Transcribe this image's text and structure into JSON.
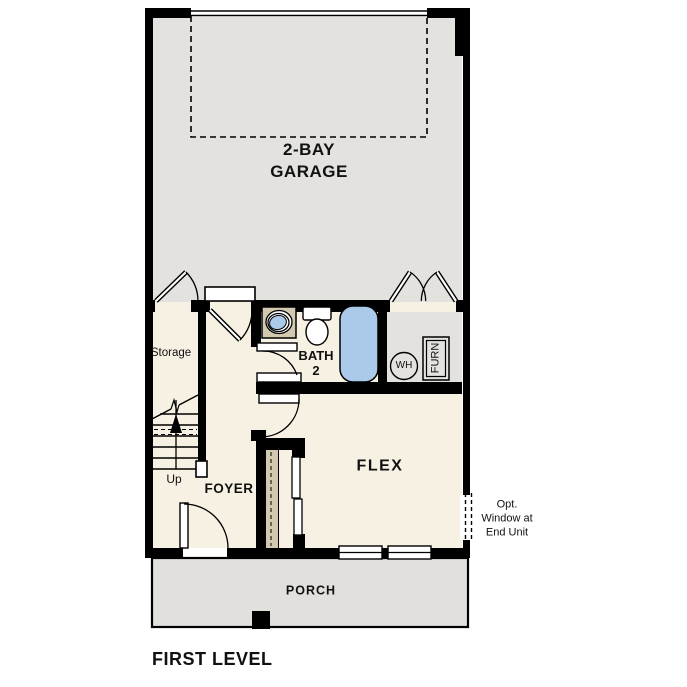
{
  "page_title": "FIRST LEVEL",
  "colors": {
    "wall": "#000000",
    "room_cream": "#F6F1E3",
    "garage_gray": "#E3E2DE",
    "porch_gray": "#E1E0DC",
    "counter_tan": "#D3C9B1",
    "fixture_blue": "#ABC9E9",
    "background": "#FFFFFF"
  },
  "rooms": {
    "garage": {
      "label": "2-BAY\nGARAGE"
    },
    "storage": {
      "label": "Storage"
    },
    "bath": {
      "label": "BATH\n2"
    },
    "foyer": {
      "label": "FOYER"
    },
    "flex": {
      "label": "FLEX"
    },
    "porch": {
      "label": "PORCH"
    }
  },
  "stairs": {
    "label": "Up"
  },
  "equipment": {
    "water_heater": "WH",
    "furnace": "FURN"
  },
  "annotations": {
    "optional_window": "Opt.\nWindow at\nEnd Unit"
  }
}
